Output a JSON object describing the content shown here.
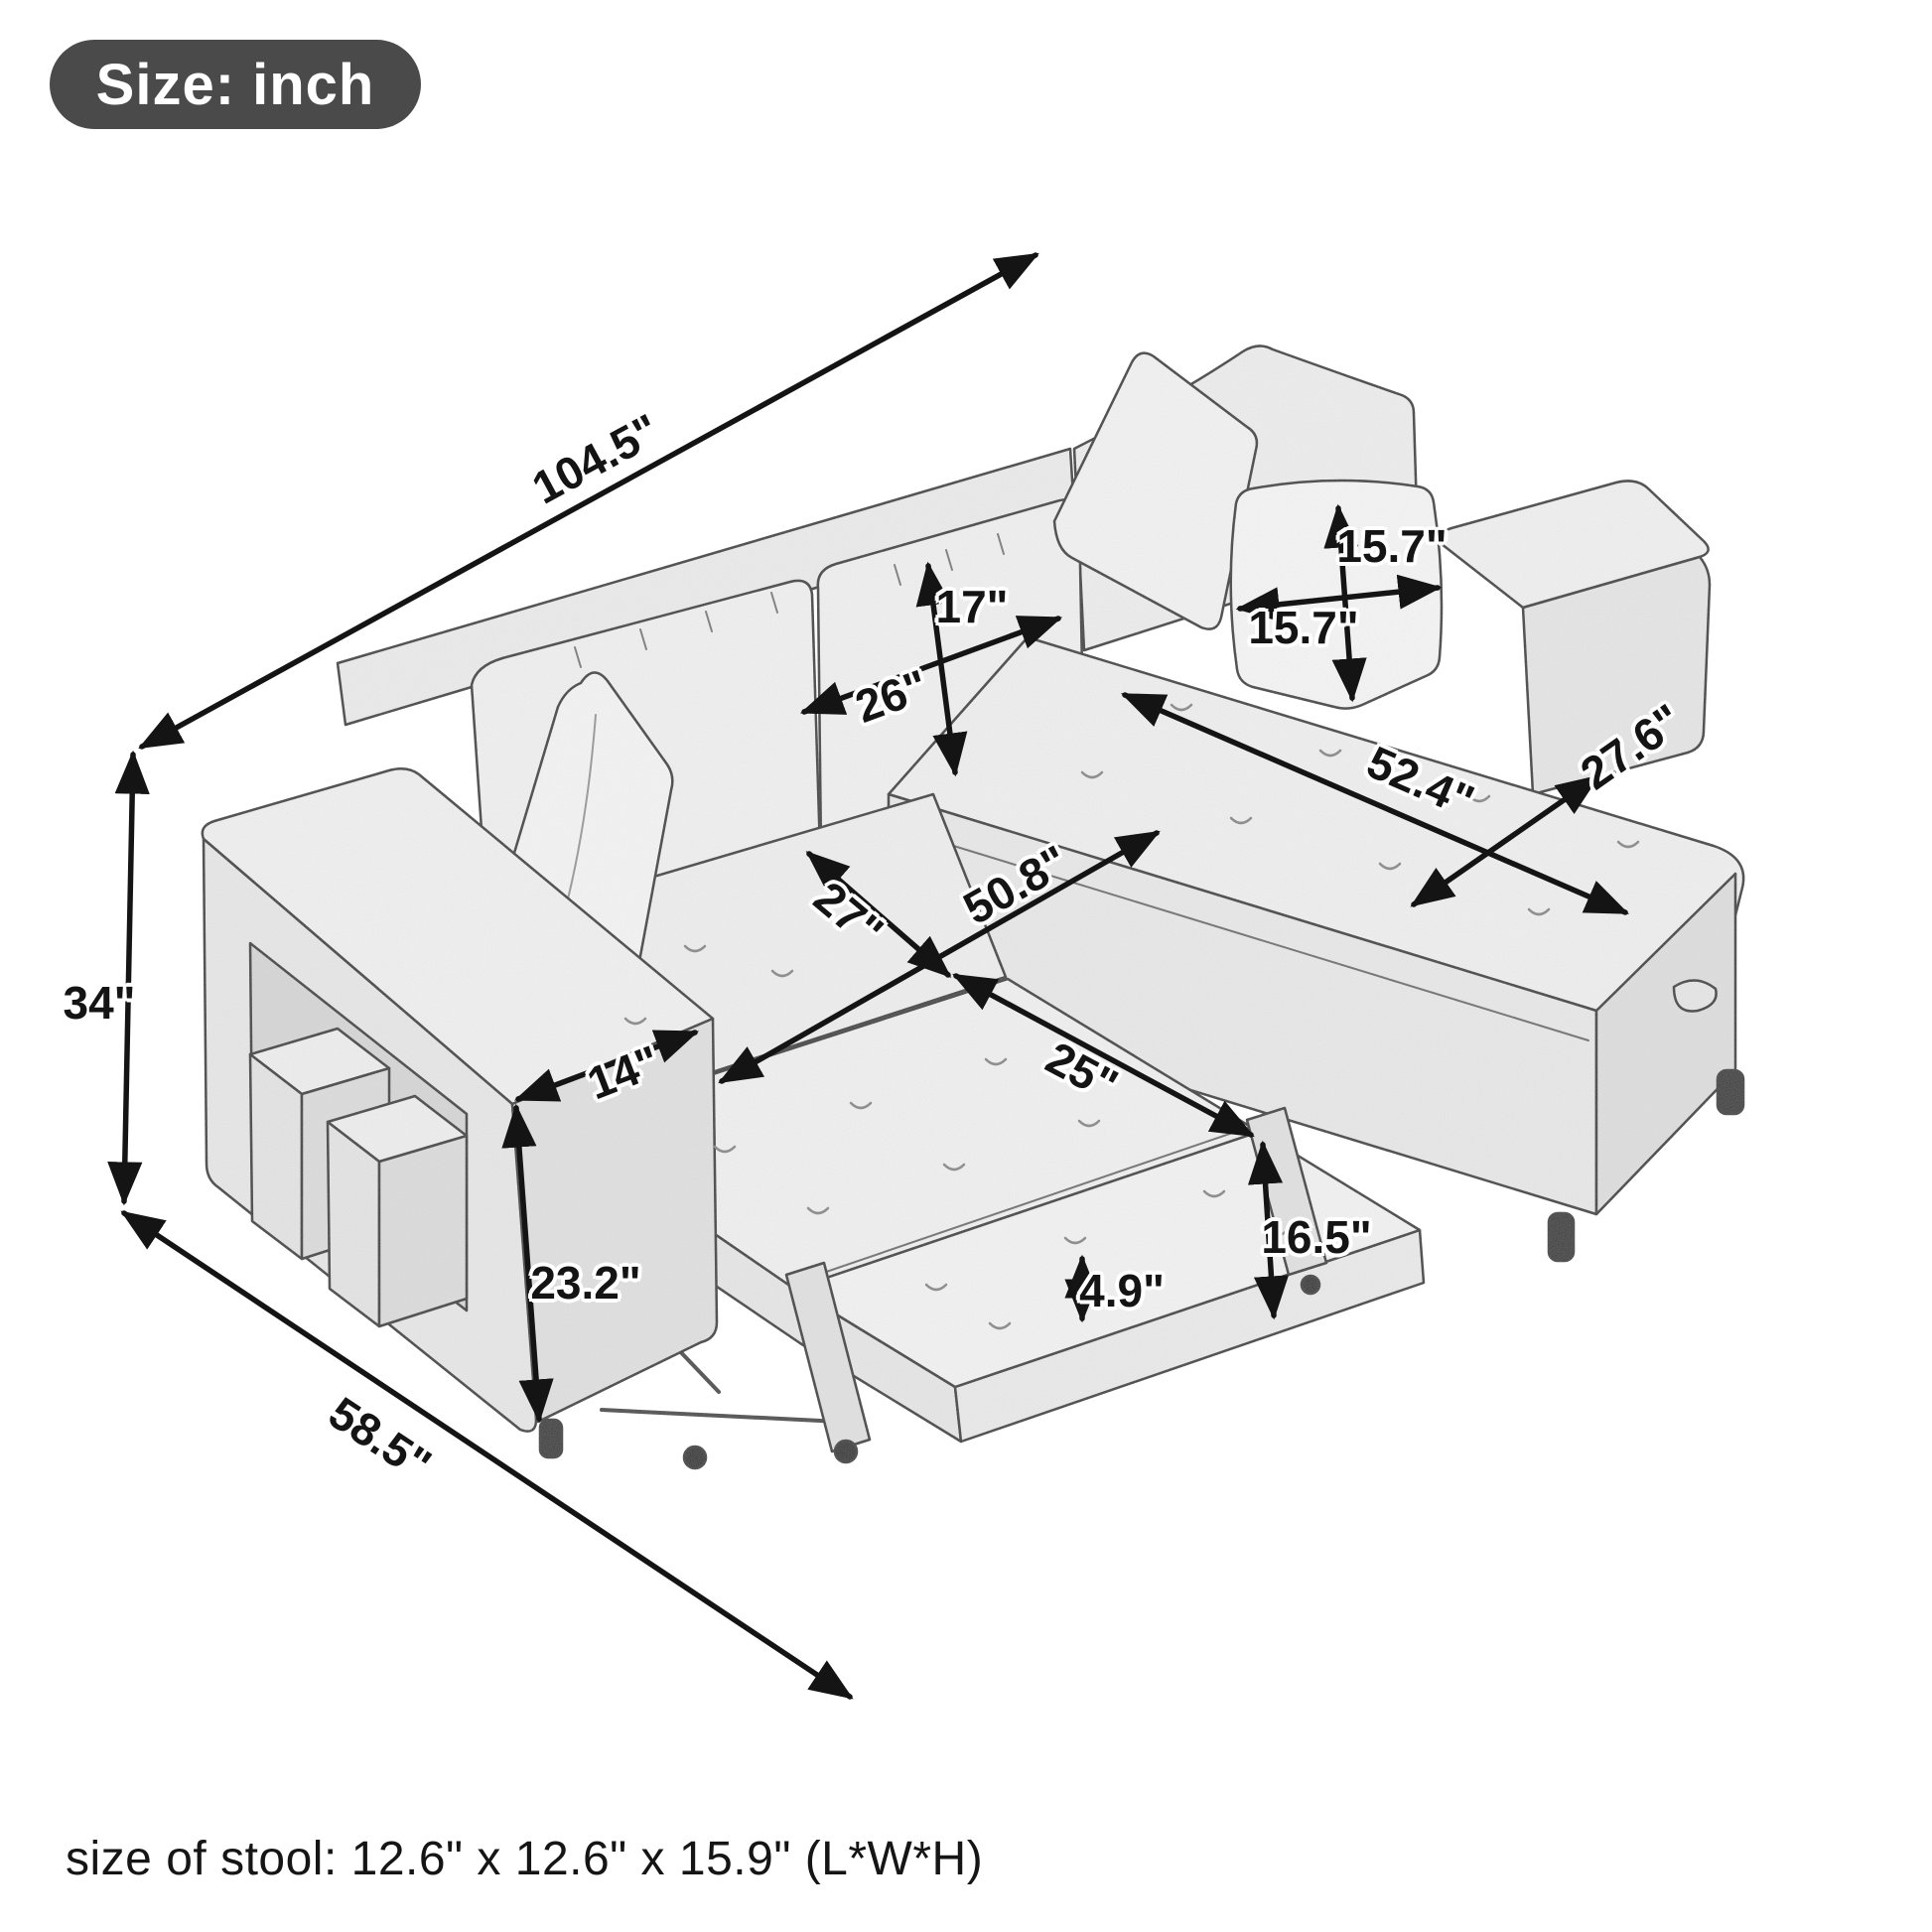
{
  "badge": {
    "label": "Size: inch"
  },
  "footnote": "size of stool: 12.6\" x 12.6\" x 15.9\" (L*W*H)",
  "dimensions": {
    "overall_width": "104.5\"",
    "overall_height": "34\"",
    "overall_depth": "58.5\"",
    "back_cushion_height": "17\"",
    "back_cushion_width": "26\"",
    "pillow_height": "15.7\"",
    "pillow_width": "15.7\"",
    "chaise_length": "52.4\"",
    "chaise_width": "27.6\"",
    "seat_depth": "27\"",
    "bed_length": "50.8\"",
    "bed_panel_width": "25\"",
    "armrest_width": "14\"",
    "armrest_height": "23.2\"",
    "bed_height": "16.5\"",
    "mattress_thickness": "4.9\""
  },
  "colors": {
    "line": "#1c1c1c",
    "sketch_outline": "#3e3e3e",
    "badge_bg": "#4a4a4a",
    "badge_text": "#ffffff",
    "fabric_light": "#f3f3f3"
  }
}
